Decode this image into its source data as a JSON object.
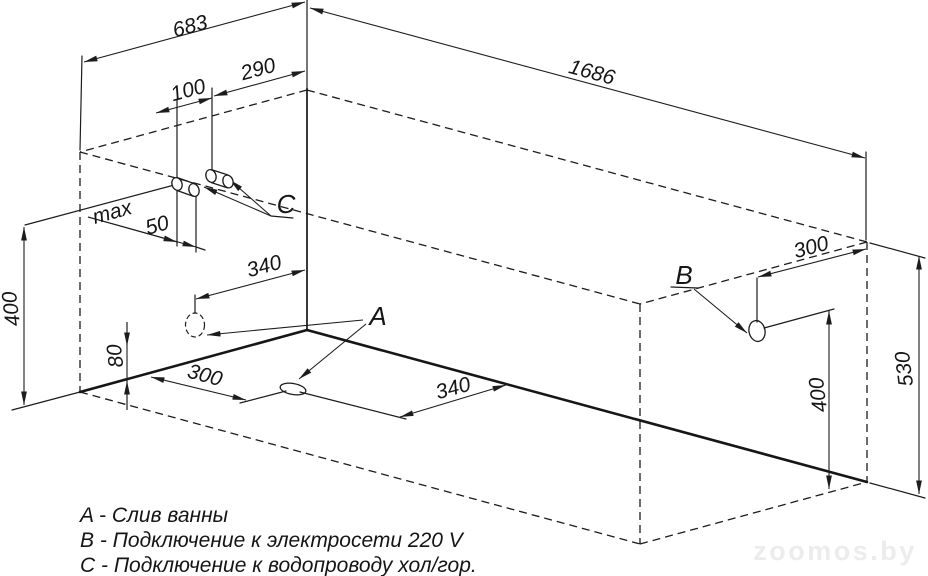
{
  "diagram": {
    "title_hint": "bathtub installation scheme, axonometric wireframe",
    "dim_labels": {
      "width_683": "683",
      "length_1686": "1686",
      "c_offset_290": "290",
      "c_spacing_100": "100",
      "max_word": "max",
      "max_value_50": "50",
      "wall_340": "340",
      "drain_height_80": "80",
      "pipes_height_400": "400",
      "floor_300": "300",
      "floor_340": "340",
      "b_offset_300": "300",
      "b_height_400": "400",
      "rim_height_530": "530"
    },
    "point_labels": {
      "drain": "A",
      "power": "B",
      "water": "C"
    },
    "legend": {
      "items": [
        "A - Слив ванны",
        "B - Подключение к электросети 220 V",
        "C - Подключение к водопроводу хол/гор."
      ]
    },
    "watermark": "zoomos.by"
  }
}
